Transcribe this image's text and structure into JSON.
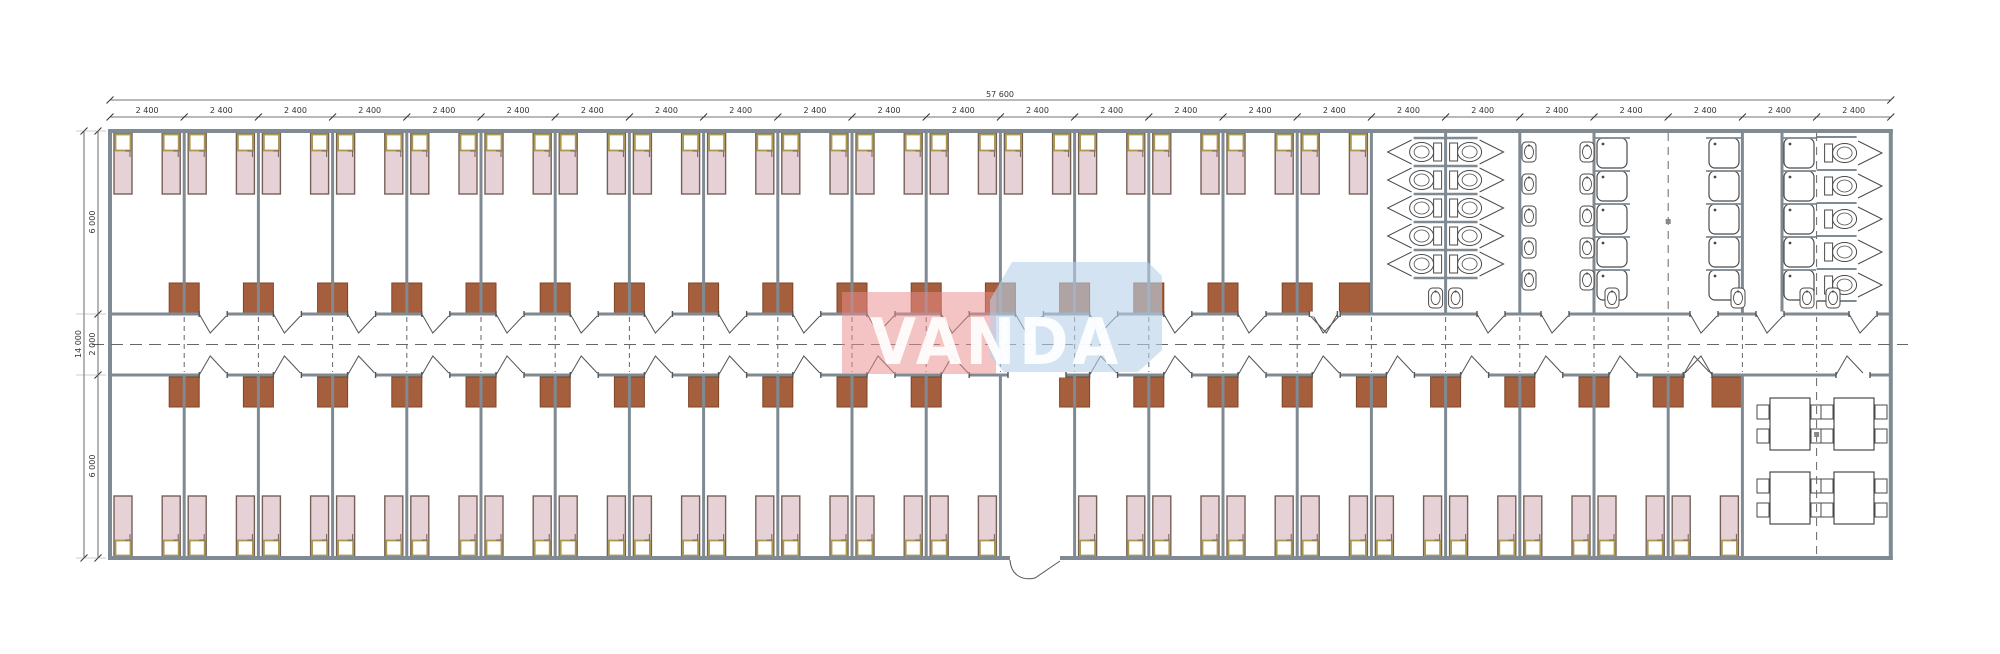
{
  "watermark": {
    "text": "VANDA"
  },
  "dimensions": {
    "total_width": "57 600",
    "bay": "2 400",
    "bay_count": 24,
    "total_height": "14 000",
    "top_depth": "6 000",
    "corridor_depth": "2 000",
    "bottom_depth": "6 000"
  },
  "layout": {
    "top_bedrooms": 17,
    "bottom_bedrooms": 21,
    "beds_per_room": 2,
    "toilet_count": 15,
    "wash_basin_count": 16,
    "shower_count": 15,
    "table_count": 4
  },
  "colors": {
    "wall": "#7f8a92",
    "wall_dark": "#5b656c",
    "bed_fill": "#e6d1d6",
    "bed_stroke": "#756059",
    "pillow_fill": "#ffffff",
    "pillow_stroke": "#ab9a4e",
    "door_fill": "#a65f3d",
    "door_stroke": "#7d4527",
    "line": "#4c4c4c",
    "dash": "#666666",
    "dim": "#333333",
    "wm_red": "#ea8c8c",
    "wm_blue": "#b5d0ea",
    "wm_text": "#ffffff"
  }
}
